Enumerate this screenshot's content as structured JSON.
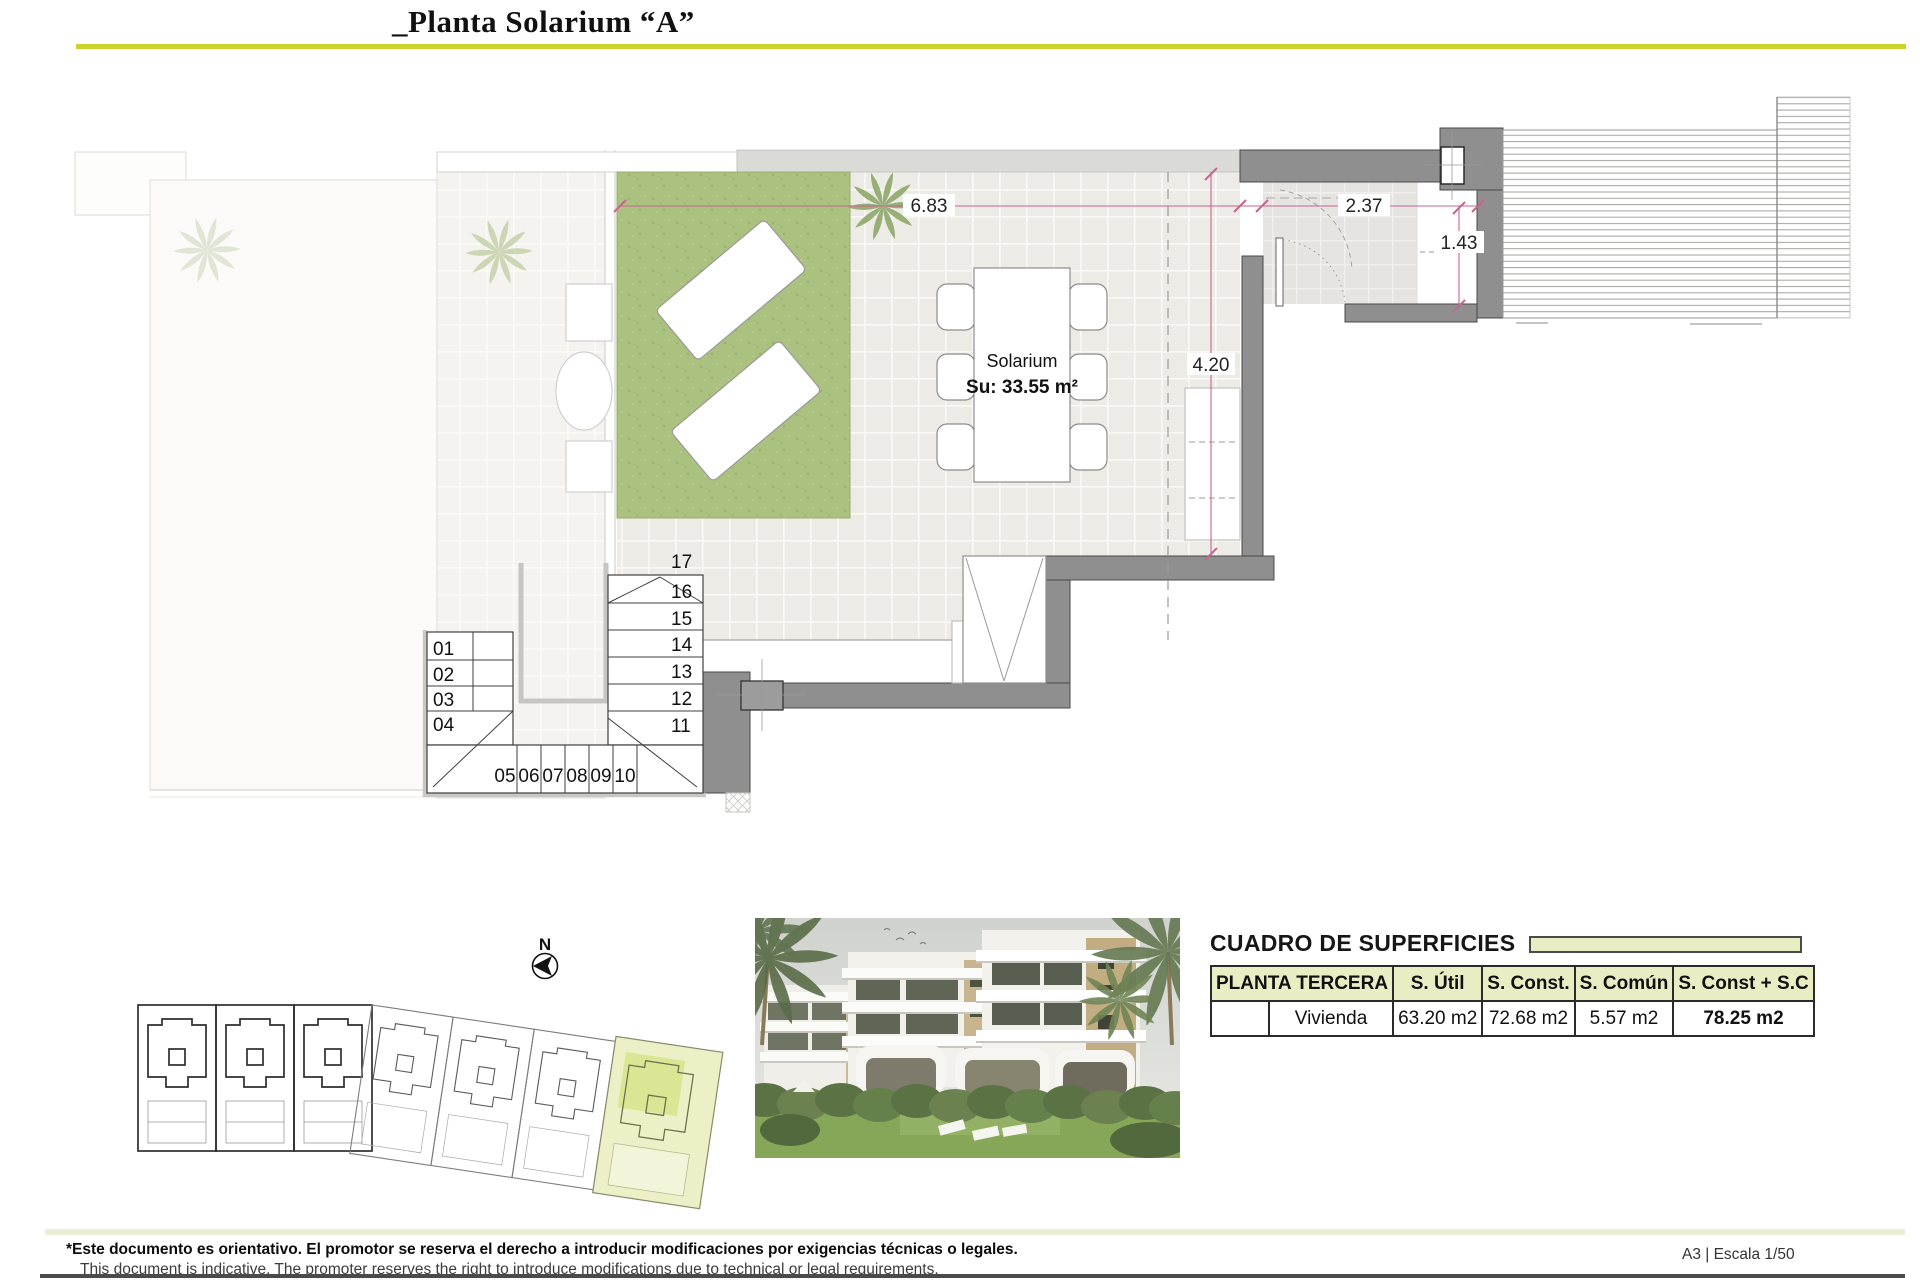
{
  "header": {
    "title": "_Planta Solarium “A”"
  },
  "plan": {
    "solarium_name": "Solarium",
    "solarium_area": "Su: 33.55 m²",
    "dim_top_left": "6.83",
    "dim_top_right": "2.37",
    "dim_right": "1.43",
    "dim_middle": "4.20",
    "stairs": {
      "right": [
        "17",
        "16",
        "15",
        "14",
        "13",
        "12",
        "11"
      ],
      "left": [
        "01",
        "02",
        "03",
        "04"
      ],
      "bottom": [
        "05",
        "06",
        "07",
        "08",
        "09",
        "10"
      ]
    }
  },
  "site_plan": {
    "north_label": "N"
  },
  "surfaces": {
    "title": "CUADRO DE SUPERFICIES",
    "floor_header": "PLANTA TERCERA",
    "col_util": "S. Útil",
    "col_const": "S. Const.",
    "col_comun": "S. Común",
    "col_total": "S. Const + S.C",
    "row_label": "Vivienda",
    "util": "63.20 m2",
    "const": "72.68 m2",
    "comun": "5.57 m2",
    "total": "78.25 m2"
  },
  "footer": {
    "disclaimer_es": "*Este documento es orientativo. El promotor se reserva el derecho a introducir modificaciones por exigencias técnicas o legales.",
    "disclaimer_en": "This document is indicative. The promoter reserves the right to introduce modifications due to technical or legal requirements.",
    "sheet_info": "A3 | Escala 1/50"
  },
  "colors": {
    "accent": "#cdd32f",
    "table_header_bg": "#e9edc4",
    "highlight_unit": "#edf0c6",
    "lawn": "#abc180",
    "wall": "#8f8f8f",
    "dimension": "#c7648f"
  }
}
